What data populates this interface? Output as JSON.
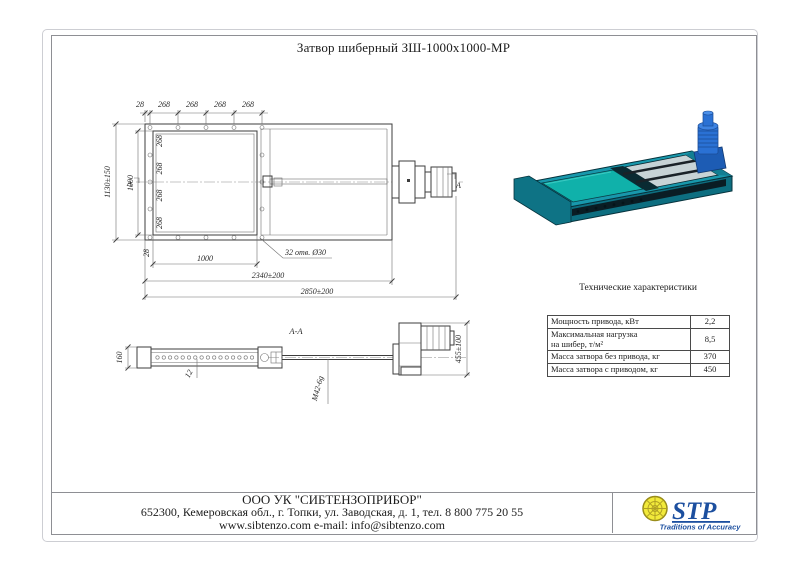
{
  "page": {
    "title": "Затвор шиберный ЗШ-1000х1000-МР"
  },
  "main_view": {
    "top_dims": [
      "28",
      "268",
      "268",
      "268",
      "268"
    ],
    "left_segment_dims": [
      "268",
      "268",
      "268",
      "268"
    ],
    "overall_height": "1130±150",
    "opening_height": "1000",
    "opening_width": "1000",
    "flange_edge": "28",
    "holes_note": "32 отв. Ø30",
    "body_length": "2340±200",
    "overall_length": "2850±200",
    "section_mark": "А"
  },
  "section_view": {
    "label": "А-А",
    "body_height": "160",
    "holes_count": "12",
    "screw_thread": "М42-6g",
    "drive_height": "455±100"
  },
  "specs": {
    "title": "Технические характеристики",
    "rows": [
      {
        "param": "Мощность привода, кВт",
        "param2": "",
        "value": "2,2"
      },
      {
        "param": "Максимальная нагрузка",
        "param2": "на шибер, т/м²",
        "value": "8,5"
      },
      {
        "param": "Масса затвора без привода, кг",
        "param2": "",
        "value": "370"
      },
      {
        "param": "Масса затвора с приводом, кг",
        "param2": "",
        "value": "450"
      }
    ]
  },
  "footer": {
    "company": "ООО УК \"СИБТЕНЗОПРИБОР\"",
    "address": "652300, Кемеровская обл., г. Топки, ул. Заводская, д. 1, тел. 8 800 775 20 55",
    "contacts": "www.sibtenzo.com e-mail: info@sibtenzo.com",
    "logo_text": "STP",
    "logo_tagline": "Traditions of Accuracy"
  },
  "colors": {
    "body_teal": "#1898ac",
    "cover_teal": "#10b1aa",
    "motor_blue": "#2a71d4",
    "logo_blue": "#1c4f9f",
    "logo_yellow": "#f2ea3a"
  }
}
